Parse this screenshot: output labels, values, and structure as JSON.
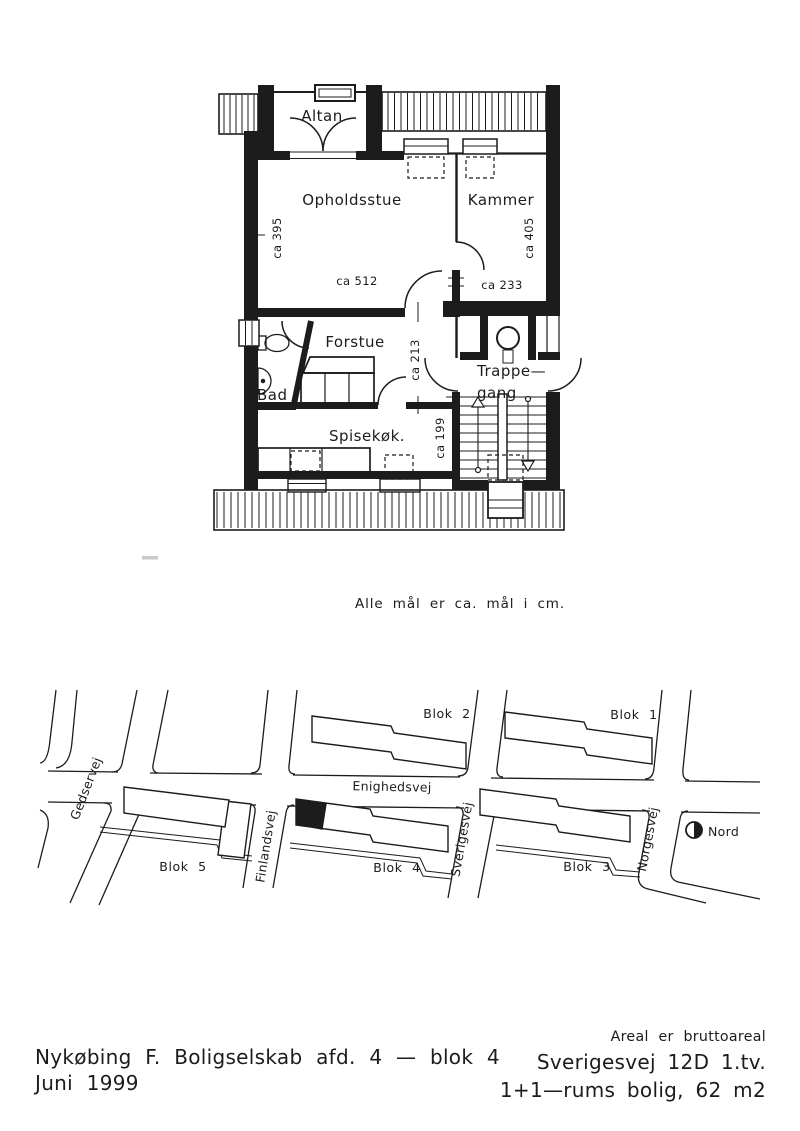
{
  "floorplan": {
    "rooms": {
      "altan": "Altan",
      "opholdsstue": "Opholdsstue",
      "kammer": "Kammer",
      "forstue": "Forstue",
      "bad": "Bad",
      "spisekok": "Spisekøk.",
      "trappegang_line1": "Trappe—",
      "trappegang_line2": "gang"
    },
    "measurements": {
      "opholdsstue_depth": "ca 395",
      "opholdsstue_width": "ca 512",
      "kammer_depth": "ca 405",
      "kammer_width": "ca 233",
      "forstue_width": "ca 213",
      "spisekok_width": "ca 199"
    },
    "note": "Alle mål er ca. mål i cm."
  },
  "sitemap": {
    "streets": {
      "gedservej": "Gedservej",
      "enighedsvej": "Enighedsvej",
      "finlandsvej": "Finlandsvej",
      "sverigesvej": "Sverigesvej",
      "norgesvej": "Norgesvej"
    },
    "blocks": {
      "blok1": "Blok 1",
      "blok2": "Blok 2",
      "blok3": "Blok 3",
      "blok4": "Blok 4",
      "blok5": "Blok 5"
    },
    "compass_label": "Nord"
  },
  "footer": {
    "company_line": "Nykøbing F. Boligselskab afd. 4 — blok 4",
    "date_line": "Juni 1999",
    "area_note": "Areal er bruttoareal",
    "address": "Sverigesvej 12D 1.tv.",
    "apartment": "1+1—rums bolig, 62 m2"
  },
  "colors": {
    "ink": "#1c1c1c",
    "paper": "#ffffff"
  }
}
